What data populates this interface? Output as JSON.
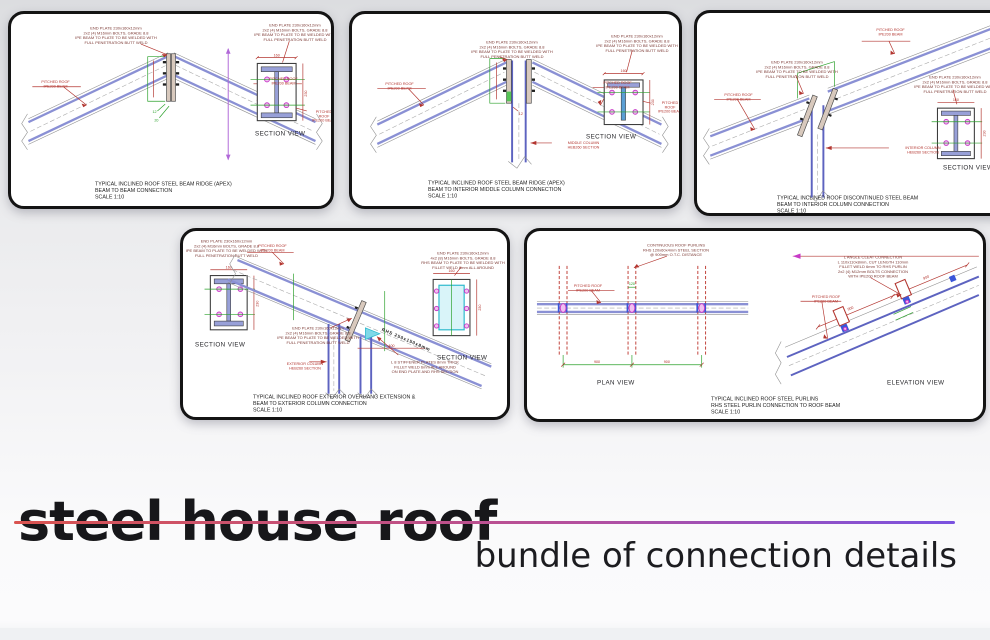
{
  "page": {
    "title": "steel house roof",
    "subtitle": "bundle of connection details",
    "accent_line": {
      "start_color": "#d9534f",
      "end_color": "#7a52e0"
    }
  },
  "colors": {
    "panel_border": "#141414",
    "beam_blue": "#8a90d4",
    "beam_dark_blue": "#5d63c0",
    "dimension_red": "#b33630",
    "dimension_green": "#2aa02a",
    "bolt_magenta": "#c73bc7",
    "highlight_cyan": "#2ab8cc",
    "note_text": "#7c3a35",
    "caption_text": "#222222"
  },
  "panels": [
    {
      "name": "apex-beam-to-beam",
      "caption": [
        "TYPICAL INCLINED ROOF STEEL BEAM RIDGE (APEX)",
        "BEAM TO BEAM CONNECTION",
        "SCALE 1:10"
      ],
      "section_view_label": "SECTION VIEW",
      "notes": {
        "end_plate": [
          "END PLATE 230x160x12mm",
          "2x2 (4) M16mm BOLTS, GRADE 8.8",
          "IPE BEAM TO PLATE TO BE WELDED WITH",
          "FULL PENETRATION BUTT WELD"
        ]
      },
      "labels": {
        "left_beam": [
          "PITCHED ROOF",
          "IPE200 BEAM"
        ],
        "right_beam": [
          "PITCHED ROOF",
          "IPE200 BEAM"
        ],
        "section_beam": [
          "PITCHED ROOF",
          "IPE200 BEAM"
        ]
      },
      "dims": {
        "plate_width": "160",
        "plate_height": "230",
        "weld": "12",
        "edge": "20"
      }
    },
    {
      "name": "apex-beam-to-middle-column",
      "caption": [
        "TYPICAL INCLINED ROOF STEEL BEAM RIDGE (APEX)",
        "BEAM TO INTERIOR MIDDLE COLUMN CONNECTION",
        "SCALE 1:10"
      ],
      "section_view_label": "SECTION VIEW",
      "notes": {
        "end_plate": [
          "END PLATE 230x160x12mm",
          "2x2 (4) M16mm BOLTS, GRADE 8.8",
          "IPE BEAM TO PLATE TO BE WELDED WITH",
          "FULL PENETRATION BUTT WELD"
        ]
      },
      "labels": {
        "left_beam": [
          "PITCHED ROOF",
          "IPE200 BEAM"
        ],
        "right_beam": [
          "PITCHED ROOF",
          "IPE200 BEAM"
        ],
        "column": [
          "MIDDLE COLUMN",
          "HEB260 SECTION"
        ],
        "section_beam": [
          "PITCHED ROOF",
          "IPE200 BEAM"
        ]
      },
      "dims": {
        "plate_width": "160",
        "plate_height": "230",
        "weld": "12"
      }
    },
    {
      "name": "discontinued-beam-to-interior-column",
      "caption": [
        "TYPICAL INCLINED ROOF DISCONTINUED STEEL BEAM",
        "BEAM TO INTERIOR COLUMN CONNECTION",
        "SCALE 1:10"
      ],
      "section_view_label": "SECTION VIEW",
      "notes": {
        "end_plate": [
          "END PLATE 230x160x12mm",
          "2x2 (4) M16mm BOLTS, GRADE 8.8",
          "IPE BEAM TO PLATE TO BE WELDED WITH",
          "FULL PENETRATION BUTT WELD"
        ]
      },
      "labels": {
        "left_beam": [
          "PITCHED ROOF",
          "IPE200 BEAM"
        ],
        "top_beam": [
          "PITCHED ROOF",
          "IPE200 BEAM"
        ],
        "column": [
          "INTERIOR COLUMN",
          "HEB260 SECTION"
        ]
      },
      "dims": {
        "plate_width": "160",
        "plate_height": "230"
      }
    },
    {
      "name": "exterior-overhang-extension",
      "caption": [
        "TYPICAL INCLINED ROOF EXTERIOR OVERHANG EXTENSION &",
        "BEAM TO EXTERIOR COLUMN CONNECTION",
        "SCALE 1:10"
      ],
      "section_view_label": "SECTION VIEW",
      "notes": {
        "end_plate_ipe": [
          "END PLATE 230x160x12mm",
          "2x2 (4) M16mm BOLTS, GRADE 8.8",
          "IPE BEAM TO PLATE TO BE WELDED WITH",
          "FULL PENETRATION BUTT WELD"
        ],
        "end_plate_rhs": [
          "END PLATE 230x160x12mm",
          "4x2 (8) M16mm BOLTS, GRADE 8.8",
          "RHS BEAM TO PLATE TO BE WELDED WITH",
          "FILLET WELD 6mm ALL AROUND"
        ],
        "stiffener": [
          "L 8 STIFFENER PLATES 8mm THICK",
          "FILLET WELD 6mm ALL AROUND",
          "ON END PLATE AND RHS SECTION"
        ]
      },
      "labels": {
        "roof_beam": [
          "PITCHED ROOF",
          "IPE200 BEAM"
        ],
        "column": [
          "EXTERIOR COLUMN",
          "HEB260 SECTION"
        ],
        "rhs_beam": "RHS 250x150x8mm"
      },
      "dims": {
        "plate_width": "160",
        "plate_height": "230",
        "overhang": "400"
      }
    },
    {
      "name": "roof-purlins",
      "caption": [
        "TYPICAL INCLINED ROOF STEEL PURLINS",
        "RHS STEEL PURLIN CONNECTION TO ROOF BEAM",
        "SCALE 1:10"
      ],
      "plan_view_label": "PLAN VIEW",
      "elevation_view_label": "ELEVATION VIEW",
      "notes": {
        "purlins": [
          "CONTINUOUS ROOF PURLINS",
          "RHS 120x60x4mm STEEL SECTION",
          "@ 900mm O.T.C. DISTANCE"
        ],
        "cleat": [
          "L ANGLE CLEAT CONNECTION",
          "L 110x110x8mm, CUT LENGTH 110mm",
          "FILLET WELD 6mm TO RHS PURLIN",
          "2x2 (4) M12mm BOLTS CONNECTION",
          "WITH IPE200 ROOF BEAM"
        ]
      },
      "labels": {
        "roof_beam_plan": [
          "PITCHED ROOF",
          "IPE200 BEAM"
        ],
        "roof_beam_elev": [
          "PITCHED ROOF",
          "IPE200 BEAM"
        ]
      },
      "dims": {
        "spacing1": "900",
        "spacing2": "900",
        "purlin_width": "120",
        "slope1": "900",
        "slope2": "900"
      }
    }
  ]
}
